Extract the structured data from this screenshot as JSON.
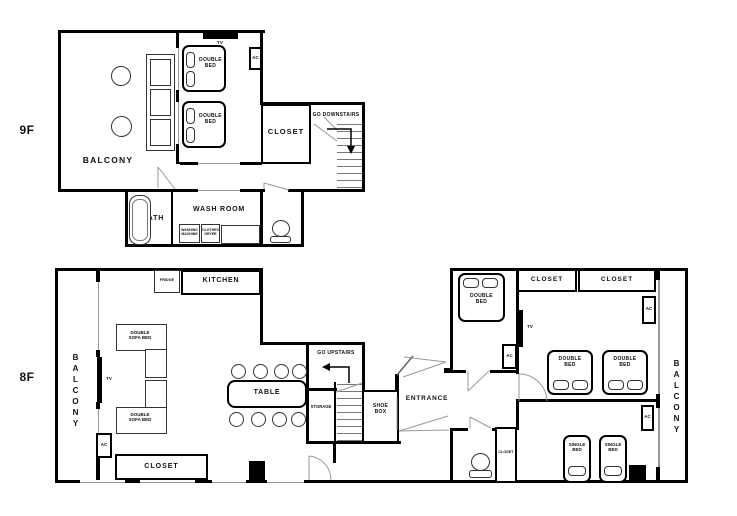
{
  "colors": {
    "wall": "#000000",
    "background": "#ffffff",
    "detail_line": "#999999"
  },
  "f9": {
    "floor_label": "9F",
    "balcony": "BALCONY",
    "tv": "TV",
    "ac": "AC",
    "double_bed_1": "DOUBLE BED",
    "double_bed_2": "DOUBLE BED",
    "closet": "CLOSET",
    "go_downstairs": "GO DOWNSTAIRS",
    "bath": "BATH",
    "wash_room": "WASH ROOM",
    "washing_machine": "WASHING MACHINE",
    "clothes_dryer": "CLOTHES DRYER"
  },
  "f8": {
    "floor_label": "8F",
    "balcony_left": "BALCONY",
    "balcony_right": "BALCONY",
    "fridge": "FRIDGE",
    "kitchen": "KITCHEN",
    "double_sofa_bed_1": "DOUBLE SOFA BED",
    "double_sofa_bed_2": "DOUBLE SOFA BED",
    "tv_living": "TV",
    "ac_living": "AC",
    "closet_living": "CLOSET",
    "table": "TABLE",
    "go_upstairs": "GO UPSTAIRS",
    "storage": "STORAGE",
    "shoe_box": "SHOE BOX",
    "entrance": "ENTRANCE",
    "double_bed_small": "DOUBLE BED",
    "closet_top_1": "CLOSET",
    "closet_top_2": "CLOSET",
    "tv_bedroom": "TV",
    "ac_hall": "AC",
    "double_bed_1": "DOUBLE BED",
    "double_bed_2": "DOUBLE BED",
    "ac_ne": "AC",
    "ac_e": "AC",
    "single_bed_1": "SINGLE BED",
    "single_bed_2": "SINGLE BED",
    "closet_wc": "CLOSET"
  }
}
